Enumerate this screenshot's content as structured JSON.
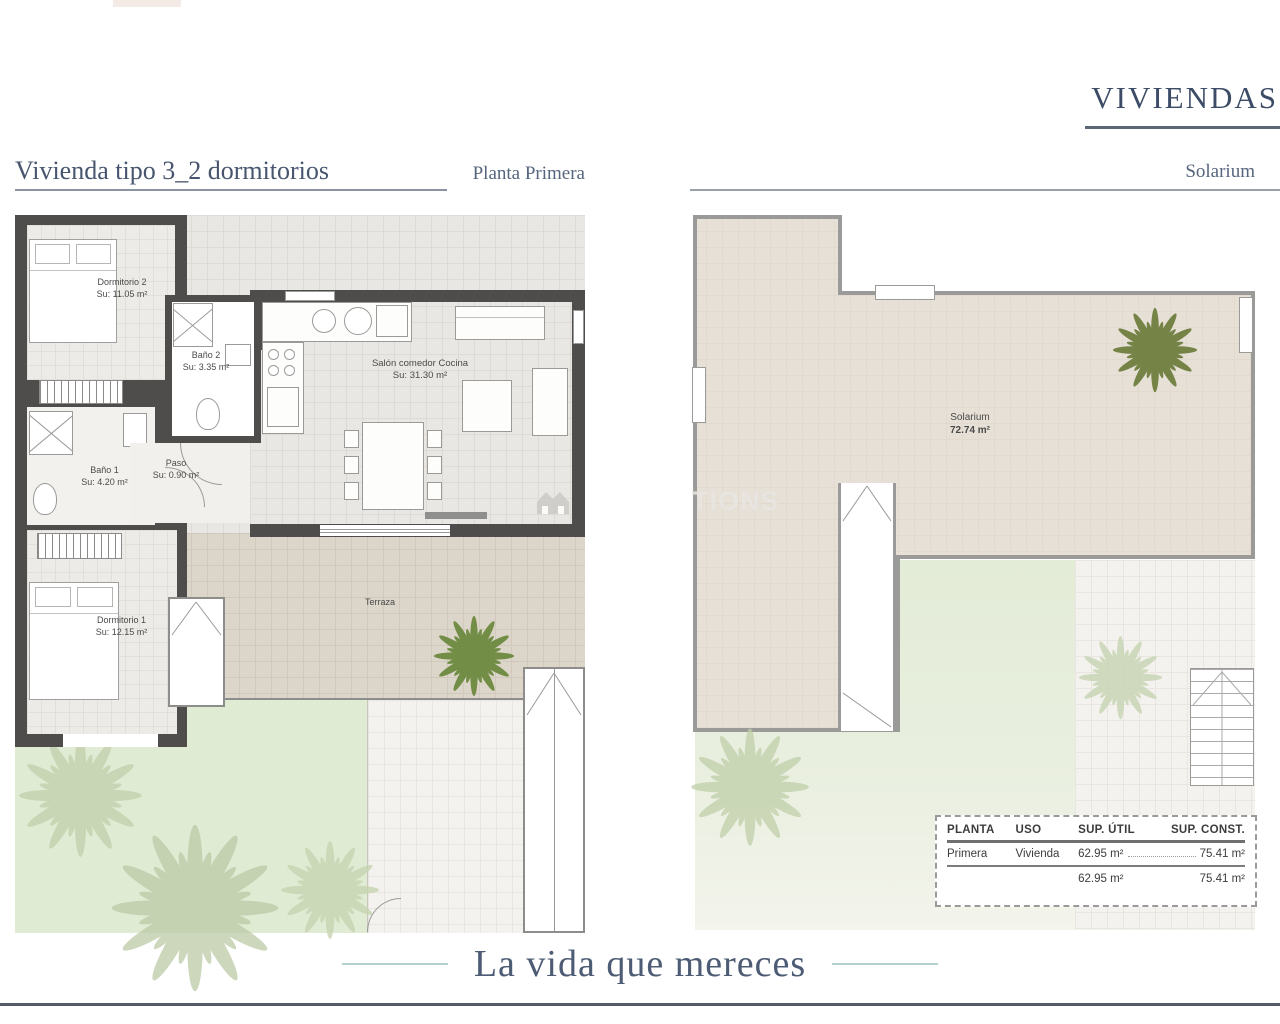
{
  "header": {
    "brand": "VIVIENDAS"
  },
  "left_plan": {
    "title": "Vivienda tipo 3_2 dormitorios",
    "subtitle": "Planta Primera",
    "rooms": {
      "dormitorio2": {
        "name": "Dormitorio 2",
        "area": "Su: 11.05 m²"
      },
      "bano2": {
        "name": "Baño 2",
        "area": "Su: 3.35 m²"
      },
      "paso": {
        "name": "Paso",
        "area": "Su: 0.90 m²"
      },
      "bano1": {
        "name": "Baño 1",
        "area": "Su: 4.20 m²"
      },
      "dormitorio1": {
        "name": "Dormitorio 1",
        "area": "Su: 12.15 m²"
      },
      "salon": {
        "name": "Salón comedor Cocina",
        "area": "Su: 31.30 m²"
      },
      "terraza": {
        "name": "Terraza"
      }
    }
  },
  "right_plan": {
    "subtitle": "Solarium",
    "room": {
      "name": "Solarium",
      "area": "72.74 m²"
    }
  },
  "watermark": {
    "visible_text": "TIONS"
  },
  "table": {
    "headers": [
      "PLANTA",
      "USO",
      "SUP. ÚTIL",
      "SUP. CONST."
    ],
    "row": {
      "planta": "Primera",
      "uso": "Vivienda",
      "sup_util": "62.95 m²",
      "sup_const": "75.41 m²"
    },
    "totals": {
      "sup_util": "62.95 m²",
      "sup_const": "75.41 m²"
    }
  },
  "footer": {
    "tagline": "La vida que mereces"
  },
  "colors": {
    "brand_blue": "#3d4c66",
    "teal_rule": "#b3d0d0",
    "wall_dark": "#4e4d4b",
    "wall_gray": "#9a9a98",
    "tile_gray": "#e9e7e3",
    "tile_warm": "#dcd5c9",
    "garden_green": "#e0ebd3",
    "palm_bright": "#6d8a3f",
    "palm_faint": "#c6d4b2"
  }
}
